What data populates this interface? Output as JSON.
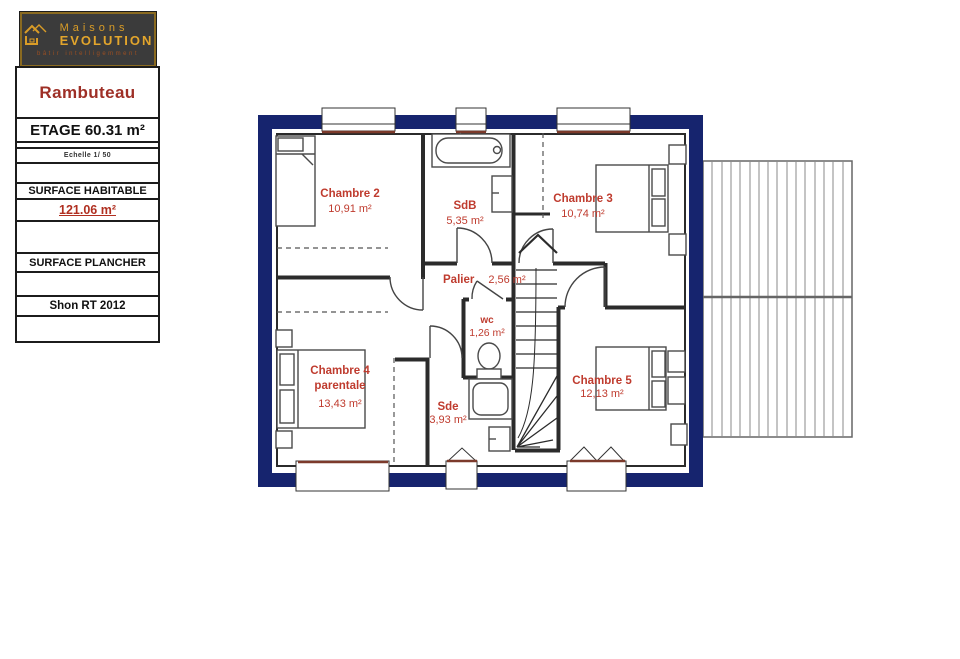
{
  "logo": {
    "line1": "Maisons",
    "line2": "EVOLUTION",
    "tagline": "bâtir intelligemment"
  },
  "sidebar": {
    "project_name": "Rambuteau",
    "etage": "ETAGE 60.31 m²",
    "echelle": "Echelle 1/ 50",
    "surface_habitable_label": "SURFACE HABITABLE",
    "surface_habitable_value": "121.06 m²",
    "surface_plancher_label": "SURFACE PLANCHER",
    "shon_label": "Shon RT 2012"
  },
  "rooms": [
    {
      "name": "Chambre 2",
      "area": "10,91 m²"
    },
    {
      "name": "SdB",
      "area": "5,35 m²"
    },
    {
      "name": "Chambre 3",
      "area": "10,74 m²"
    },
    {
      "name": "Palier",
      "area": "2,56 m²"
    },
    {
      "name": "wc",
      "area": "1,26 m²"
    },
    {
      "name": "Chambre 4",
      "name2": "parentale",
      "area": "13,43 m²"
    },
    {
      "name": "Sde",
      "area": "3,93 m²"
    },
    {
      "name": "Chambre 5",
      "area": "12,13 m²"
    }
  ],
  "colors": {
    "navy_wall": "#16246e",
    "interior_wall": "#2b2b2b",
    "room_label_red": "#bf3b2e",
    "heading_red": "#9e2f26",
    "logo_gold": "#d99c27",
    "sill_brown": "#7c3a2b"
  }
}
